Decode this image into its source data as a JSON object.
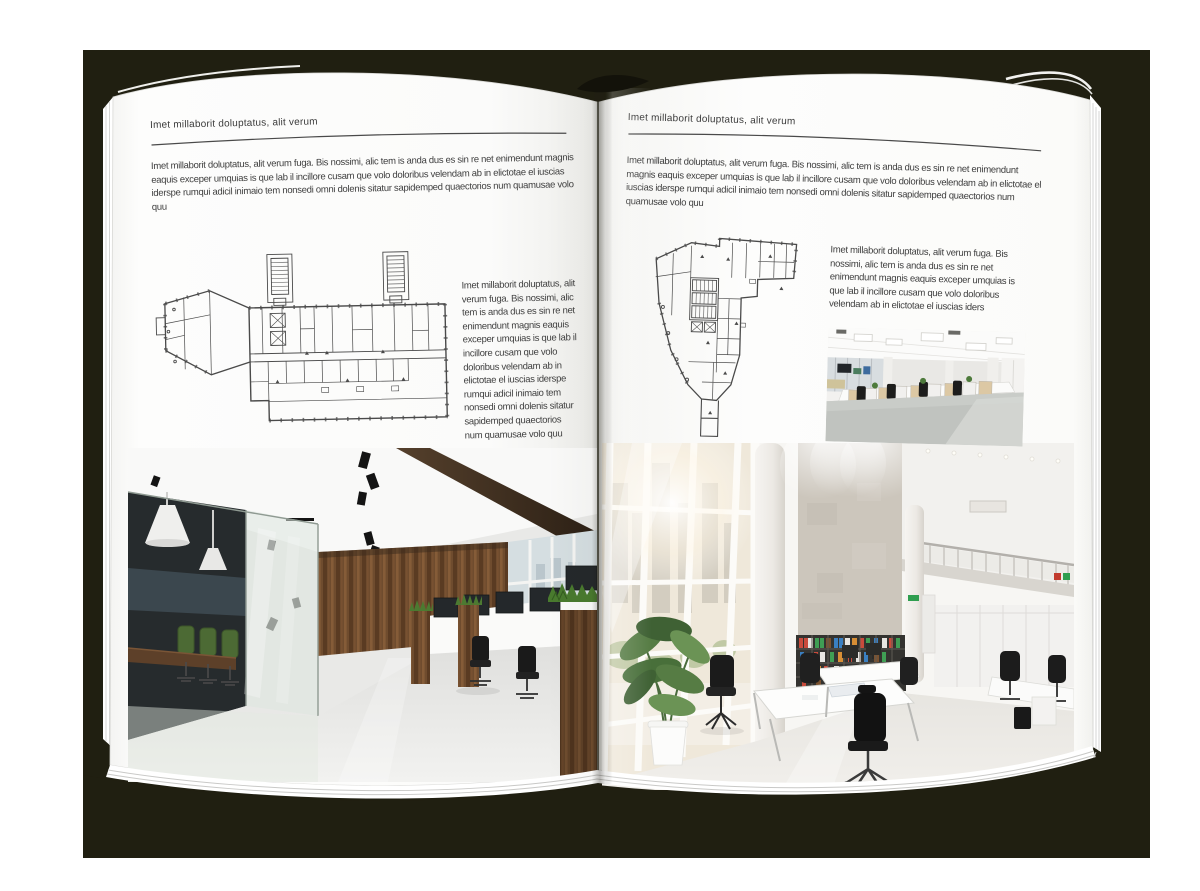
{
  "backdrop_color": "#201f11",
  "paper_color": "#ffffff",
  "ink_color": "#3f3f3f",
  "illustrations": {
    "left_floor_plan": "building-floor-plan-drawing",
    "right_floor_plan": "building-floor-plan-drawing",
    "left_photo": "loft-office-interior-photo",
    "right_photo": "atrium-office-interior-photo",
    "small_photo": "open-space-office-photo"
  },
  "left_page": {
    "kicker": "Imet millaborit doluptatus, alit verum",
    "intro": "Imet millaborit doluptatus, alit verum fuga. Bis nossimi, alic tem is anda dus es sin re net enimendunt magnis eaquis exceper umquias is que lab il incillore cusam que volo doloribus velendam ab in elictotae el iuscias iderspe rumqui adicil inimaio tem nonsedi omni dolenis sitatur sapidemped quaectorios num quamusae volo quu",
    "side_text": "Imet millaborit doluptatus, alit verum fuga. Bis nossimi, alic tem is anda dus es sin re net enimendunt magnis eaquis exceper umquias is que lab il incillore cusam que volo doloribus velendam ab in elictotae el iuscias iderspe rumqui adicil inimaio tem nonsedi omni dolenis sitatur sapidemped quaectorios num quamusae volo quu"
  },
  "right_page": {
    "kicker": "Imet millaborit doluptatus, alit verum",
    "intro": "Imet millaborit doluptatus, alit verum fuga. Bis nossimi, alic tem is anda dus es sin re net enimendunt magnis eaquis exceper umquias is que lab il incillore cusam que volo doloribus velendam ab in elictotae el iuscias iderspe rumqui adicil inimaio tem nonsedi omni dolenis sitatur sapidemped quaectorios num quamusae volo quu",
    "side_text": "Imet millaborit doluptatus, alit verum fuga. Bis nossimi, alic tem is anda dus es sin re net enimendunt magnis eaquis exceper umquias is que lab il incillore cusam que volo doloribus velendam ab in elictotae el iuscias iders"
  }
}
